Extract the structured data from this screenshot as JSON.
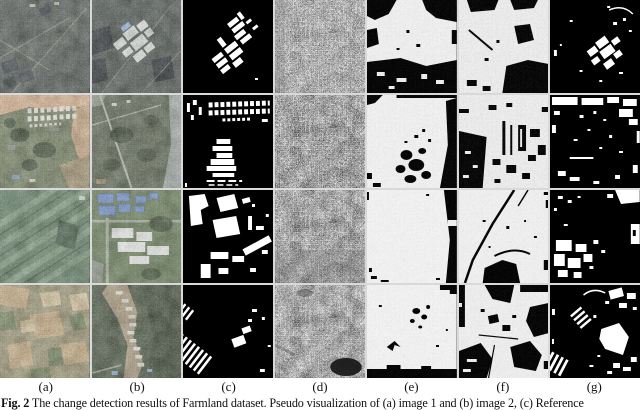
{
  "figure": {
    "column_labels": [
      "(a)",
      "(b)",
      "(c)",
      "(d)",
      "(e)",
      "(f)",
      "(g)"
    ],
    "caption": {
      "label": "Fig. 2",
      "text": " The change detection results of Farmland dataset. Pseudo visualization of (a) image 1 and (b) image 2, (c) Reference"
    },
    "palette": {
      "binary_foreground": "#ffffff",
      "binary_background": "#000000",
      "river_tan": "#d8b18c",
      "farmland_green": "#5f7c62",
      "dark_ground": "#4a514d",
      "page_background": "#ffffff"
    }
  }
}
